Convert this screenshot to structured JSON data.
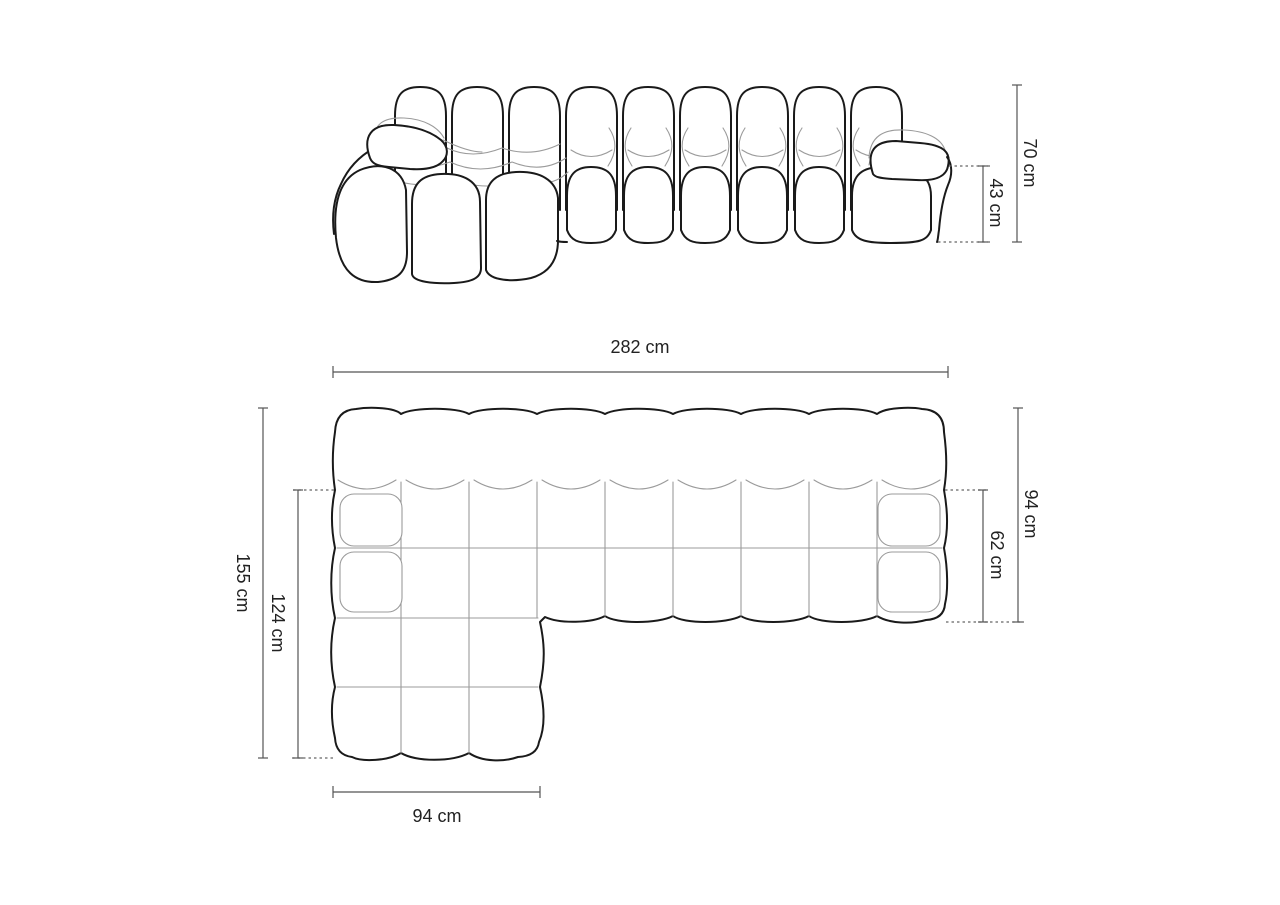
{
  "page": {
    "title": "Modular chaise sofa dimension diagram",
    "background": "#ffffff"
  },
  "diagram": {
    "subject": "tufted modular sofa with left chaise",
    "views": {
      "front": {
        "name": "front elevation view",
        "dimensions": {
          "total_height": {
            "label": "70 cm",
            "value_cm": 70
          },
          "seat_height": {
            "label": "43 cm",
            "value_cm": 43
          }
        }
      },
      "top": {
        "name": "top plan view",
        "dimensions": {
          "total_width": {
            "label": "282 cm",
            "value_cm": 282
          },
          "total_depth": {
            "label": "94 cm",
            "value_cm": 94
          },
          "seat_depth": {
            "label": "62 cm",
            "value_cm": 62
          },
          "chaise_total_length": {
            "label": "155 cm",
            "value_cm": 155
          },
          "chaise_inner_length": {
            "label": "124 cm",
            "value_cm": 124
          },
          "chaise_width": {
            "label": "94 cm",
            "value_cm": 94
          }
        }
      }
    },
    "style": {
      "outline_color": "#1a1a1a",
      "tuft_line_color": "#9b9b9b",
      "dimension_line_color": "#555555",
      "label_color": "#222222",
      "background": "#ffffff"
    }
  }
}
